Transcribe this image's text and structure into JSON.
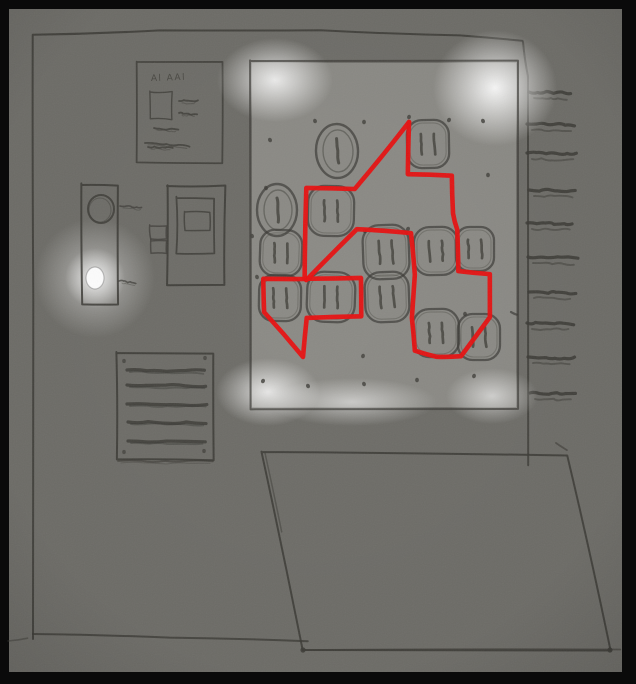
{
  "scene": {
    "width": 636,
    "height": 684
  },
  "colors": {
    "frame": "#0a0a0a",
    "paper": "#6e6d68",
    "pencil": "#3c3b36",
    "panel_base": "#8b8a85",
    "highlight": "#ffffff",
    "red": "#e81010",
    "led": "#ffffff",
    "screw": "#45443f"
  },
  "frame": {
    "left": 9,
    "top": 9,
    "right": 14,
    "bottom": 12
  },
  "cabinet": {
    "outline_left_top": [
      [
        33,
        639
      ],
      [
        33,
        300
      ],
      [
        32,
        35
      ],
      [
        160,
        31
      ],
      [
        320,
        30
      ],
      [
        460,
        36
      ],
      [
        523,
        41
      ]
    ],
    "outline_right": [
      [
        523,
        42
      ],
      [
        528,
        77
      ],
      [
        528,
        465
      ]
    ],
    "bottom": [
      [
        33,
        634
      ],
      [
        170,
        637
      ],
      [
        308,
        642
      ]
    ],
    "tick": [
      [
        8,
        641
      ],
      [
        28,
        638
      ]
    ]
  },
  "label_card": {
    "x": 137,
    "y": 62,
    "w": 85,
    "h": 101,
    "text": "Al AAl",
    "text_x": 151,
    "text_y": 81,
    "square": {
      "x": 150,
      "y": 92,
      "w": 22,
      "h": 27
    },
    "lines": [
      [
        179,
        101,
        198,
        101
      ],
      [
        179,
        113,
        197,
        114
      ],
      [
        154,
        128,
        178,
        130
      ],
      [
        145,
        143,
        189,
        146
      ],
      [
        148,
        147,
        172,
        148
      ]
    ]
  },
  "handle": {
    "x": 82,
    "y": 185,
    "w": 36,
    "h": 119,
    "knob": {
      "cx": 101,
      "cy": 209,
      "r": 13
    },
    "led": {
      "cx": 95,
      "cy": 278,
      "rx": 9,
      "ry": 11
    },
    "squiggles": [
      [
        120,
        206,
        142,
        208
      ],
      [
        119,
        281,
        136,
        283
      ]
    ]
  },
  "display": {
    "outer": {
      "x": 167,
      "y": 186,
      "w": 58,
      "h": 99
    },
    "inner": {
      "x": 177,
      "y": 198,
      "w": 37,
      "h": 55
    },
    "screen": {
      "x": 185,
      "y": 212,
      "w": 25,
      "h": 19
    },
    "tabs": [
      {
        "x": 150,
        "y": 226,
        "w": 17,
        "h": 13
      },
      {
        "x": 151,
        "y": 241,
        "w": 15,
        "h": 12
      }
    ]
  },
  "vent": {
    "x": 117,
    "y": 353,
    "w": 96,
    "h": 107,
    "lines": [
      [
        127,
        370,
        205,
        371
      ],
      [
        127,
        385,
        206,
        386
      ],
      [
        127,
        404,
        207,
        405
      ],
      [
        128,
        422,
        206,
        423
      ],
      [
        128,
        441,
        205,
        442
      ]
    ],
    "under_line": [
      118,
      461,
      212,
      462
    ],
    "screws": [
      [
        124,
        361
      ],
      [
        205,
        358
      ],
      [
        124,
        452
      ],
      [
        204,
        451
      ]
    ]
  },
  "outlet_panel": {
    "x": 252,
    "y": 63,
    "w": 264,
    "h": 344,
    "highlights": [
      {
        "cx": 275,
        "cy": 80,
        "rx": 58,
        "ry": 42,
        "o": 0.85
      },
      {
        "cx": 495,
        "cy": 88,
        "rx": 62,
        "ry": 58,
        "o": 0.95
      },
      {
        "cx": 268,
        "cy": 392,
        "rx": 52,
        "ry": 34,
        "o": 0.8
      },
      {
        "cx": 352,
        "cy": 402,
        "rx": 85,
        "ry": 24,
        "o": 0.55
      },
      {
        "cx": 492,
        "cy": 396,
        "rx": 46,
        "ry": 28,
        "o": 0.6
      }
    ],
    "screws": [
      [
        270,
        140
      ],
      [
        315,
        121
      ],
      [
        364,
        122
      ],
      [
        409,
        117
      ],
      [
        449,
        120
      ],
      [
        483,
        121
      ],
      [
        266,
        188
      ],
      [
        488,
        175
      ],
      [
        365,
        231
      ],
      [
        408,
        229
      ],
      [
        252,
        236
      ],
      [
        257,
        277
      ],
      [
        465,
        314
      ],
      [
        363,
        356
      ],
      [
        263,
        381
      ],
      [
        308,
        386
      ],
      [
        364,
        384
      ],
      [
        417,
        380
      ],
      [
        474,
        376
      ]
    ],
    "side_dash": [
      511,
      312,
      517,
      315
    ]
  },
  "outlets": [
    {
      "cx": 337,
      "cy": 151,
      "w": 42,
      "h": 54,
      "type": "ring"
    },
    {
      "cx": 428,
      "cy": 144,
      "w": 42,
      "h": 48,
      "type": "duplex"
    },
    {
      "cx": 277,
      "cy": 210,
      "w": 40,
      "h": 52,
      "type": "ring"
    },
    {
      "cx": 331,
      "cy": 211,
      "w": 46,
      "h": 50,
      "type": "duplex"
    },
    {
      "cx": 281,
      "cy": 253,
      "w": 42,
      "h": 46,
      "type": "duplex"
    },
    {
      "cx": 386,
      "cy": 252,
      "w": 46,
      "h": 54,
      "type": "duplex"
    },
    {
      "cx": 436,
      "cy": 251,
      "w": 44,
      "h": 48,
      "type": "duplex"
    },
    {
      "cx": 475,
      "cy": 249,
      "w": 38,
      "h": 44,
      "type": "duplex"
    },
    {
      "cx": 280,
      "cy": 298,
      "w": 42,
      "h": 46,
      "type": "duplex"
    },
    {
      "cx": 331,
      "cy": 297,
      "w": 48,
      "h": 50,
      "type": "duplex"
    },
    {
      "cx": 387,
      "cy": 297,
      "w": 44,
      "h": 50,
      "type": "duplex"
    },
    {
      "cx": 436,
      "cy": 333,
      "w": 46,
      "h": 48,
      "type": "duplex"
    },
    {
      "cx": 479,
      "cy": 337,
      "w": 42,
      "h": 46,
      "type": "duplex"
    }
  ],
  "hatches": [
    [
      92,
      529,
      571
    ],
    [
      124,
      527,
      575
    ],
    [
      153,
      527,
      577
    ],
    [
      190,
      529,
      576
    ],
    [
      223,
      527,
      573
    ],
    [
      257,
      528,
      577
    ],
    [
      292,
      529,
      575
    ],
    [
      323,
      527,
      573
    ],
    [
      357,
      528,
      574
    ],
    [
      393,
      530,
      575
    ]
  ],
  "door": {
    "points": [
      [
        262,
        452
      ],
      [
        567,
        455
      ],
      [
        610,
        650
      ],
      [
        303,
        650
      ]
    ],
    "tick": [
      [
        556,
        443
      ],
      [
        567,
        450
      ]
    ],
    "double_edge": [
      [
        265,
        453
      ],
      [
        282,
        532
      ]
    ],
    "bottom_ext": [
      [
        303,
        650
      ],
      [
        621,
        650
      ]
    ],
    "corner_dots": [
      [
        303,
        650
      ],
      [
        610,
        650
      ]
    ]
  },
  "red_route": {
    "color": "#e81010",
    "width": 4.6,
    "polylines": [
      [
        [
          409,
          122
        ],
        [
          408,
          174
        ],
        [
          452,
          176
        ],
        [
          453,
          213
        ],
        [
          457,
          230
        ],
        [
          458,
          271
        ],
        [
          490,
          274
        ],
        [
          490,
          317
        ],
        [
          461,
          356
        ],
        [
          437,
          357
        ],
        [
          415,
          351
        ],
        [
          412,
          318
        ],
        [
          415,
          275
        ],
        [
          411,
          233
        ],
        [
          357,
          229
        ],
        [
          306,
          280
        ]
      ],
      [
        [
          409,
          122
        ],
        [
          355,
          189
        ],
        [
          306,
          188
        ],
        [
          305,
          279
        ]
      ],
      [
        [
          305,
          279
        ],
        [
          263,
          279
        ],
        [
          264,
          312
        ],
        [
          303,
          357
        ],
        [
          307,
          318
        ],
        [
          361,
          316
        ],
        [
          361,
          278
        ],
        [
          305,
          279
        ]
      ]
    ]
  }
}
